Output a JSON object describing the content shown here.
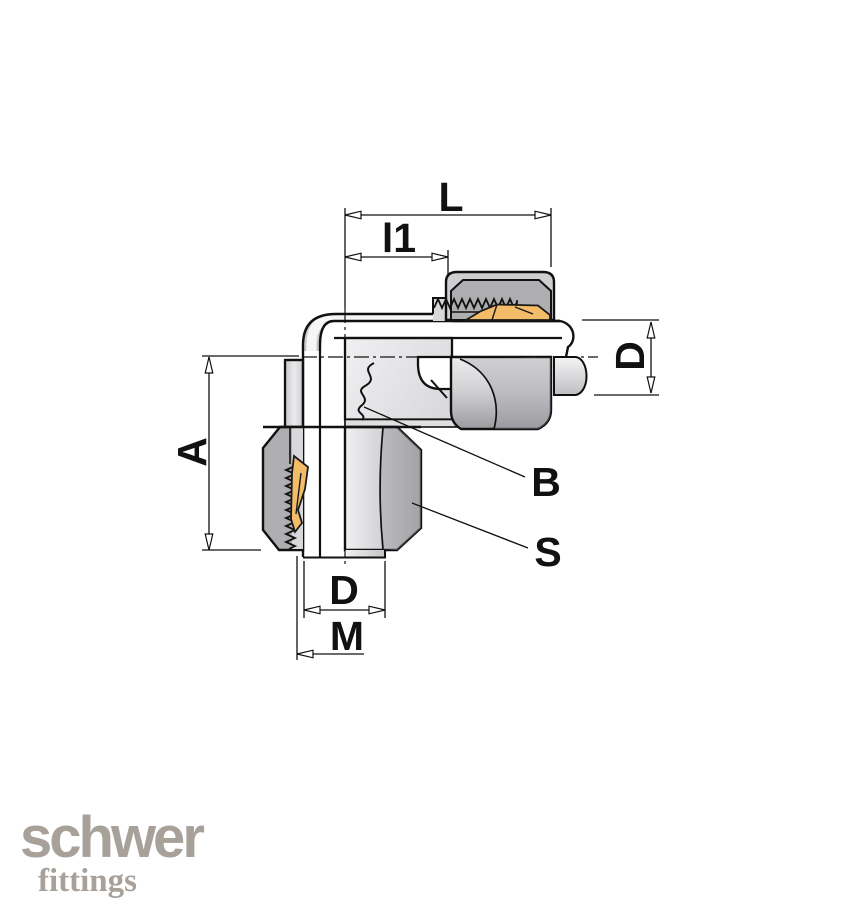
{
  "drawing": {
    "type": "technical-drawing",
    "subject": "90-degree elbow compression tube fitting, half-section view",
    "dimensions": {
      "overall_length": "L",
      "insertion_length": "l1",
      "tube_diameter_right": "D",
      "overall_height": "A",
      "body_label": "B",
      "nut_wrench_size": "S",
      "tube_diameter_bottom": "D",
      "thread_size": "M"
    },
    "colors": {
      "line": "#111111",
      "body_gray": "#e7e7e9",
      "nut_cut_gray": "#aeaeb1",
      "nut_outer_gray": "#cfcfd2",
      "ferrule_brass": "#f3bc69",
      "logo_gray": "#a7a19a",
      "background": "#ffffff"
    }
  },
  "logo": {
    "brand": "schwer",
    "sub_brand": "fittings"
  }
}
